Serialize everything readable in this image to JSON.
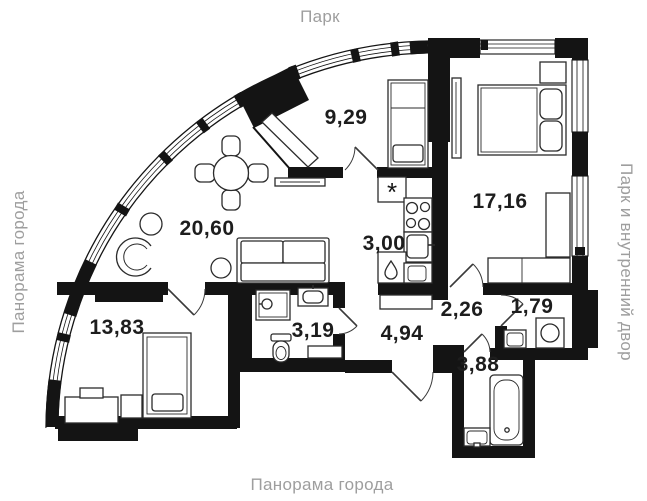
{
  "plan": {
    "surroundings": {
      "top": "Парк",
      "left": "Панорама города",
      "right": "Парк и внутренний двор",
      "bottom": "Панорама города"
    },
    "rooms": {
      "study": {
        "area": "9,29"
      },
      "bedroom": {
        "area": "17,16"
      },
      "living": {
        "area": "20,60"
      },
      "kitchen": {
        "area": "3,00"
      },
      "bedroom2": {
        "area": "13,83"
      },
      "bathroom": {
        "area": "3,19"
      },
      "hall": {
        "area": "4,94"
      },
      "corridor": {
        "area": "2,26"
      },
      "storage": {
        "area": "1,79"
      },
      "bathroom2": {
        "area": "3,88"
      }
    },
    "icons": {
      "ventilation_symbol": "*"
    },
    "colors": {
      "wall": "#141414",
      "furniture_line": "#2b2b2b",
      "room_label": "#1d1d1d",
      "surround_label": "#9e9e9e"
    }
  }
}
